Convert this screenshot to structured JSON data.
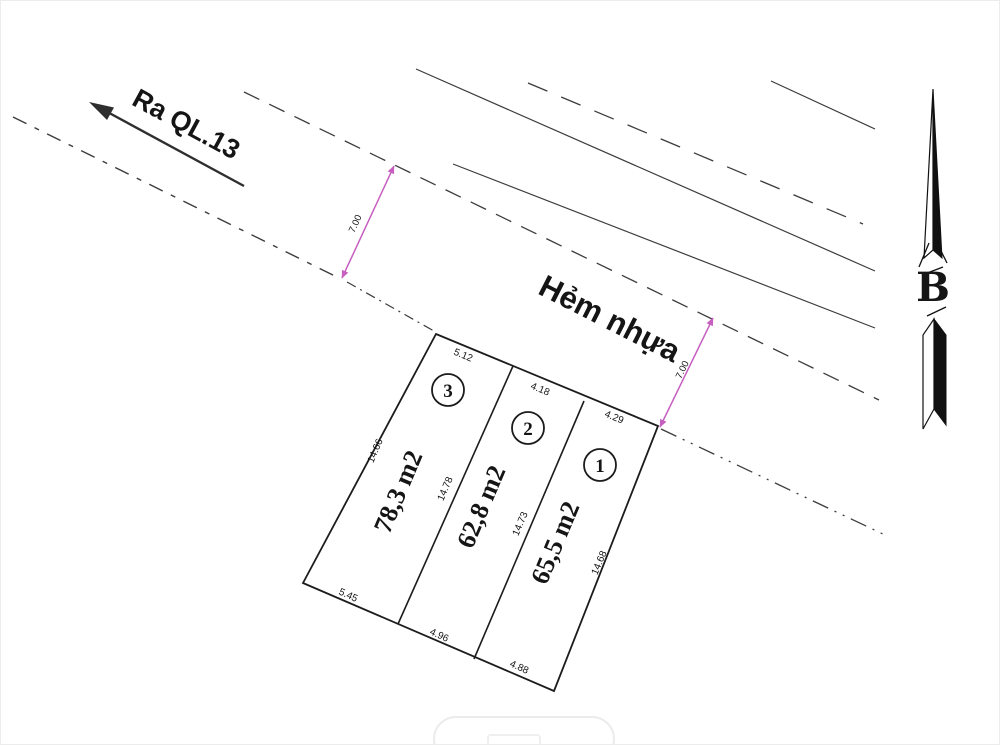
{
  "labels": {
    "highway_arrow": "Ra QL.13",
    "alley": "Hẻm nhựa",
    "north": "B"
  },
  "road_dimensions": {
    "width_left": "7.00",
    "width_right": "7.00"
  },
  "plots": [
    {
      "number": "3",
      "area": "78,3 m2",
      "front": "5.12",
      "back": "5.45"
    },
    {
      "number": "2",
      "area": "62,8 m2",
      "front": "4.18",
      "back": "4.96"
    },
    {
      "number": "1",
      "area": "65,5 m2",
      "front": "4.29",
      "back": "4.88"
    }
  ],
  "edges": {
    "left": "14.66",
    "divider_3_2": "14.78",
    "divider_2_1": "14.73",
    "right": "14.68"
  },
  "colors": {
    "line": "#2f2f2f",
    "plot_line": "#1c1c1c",
    "dimension_arrow": "#c65fc0",
    "text": "#151515"
  }
}
